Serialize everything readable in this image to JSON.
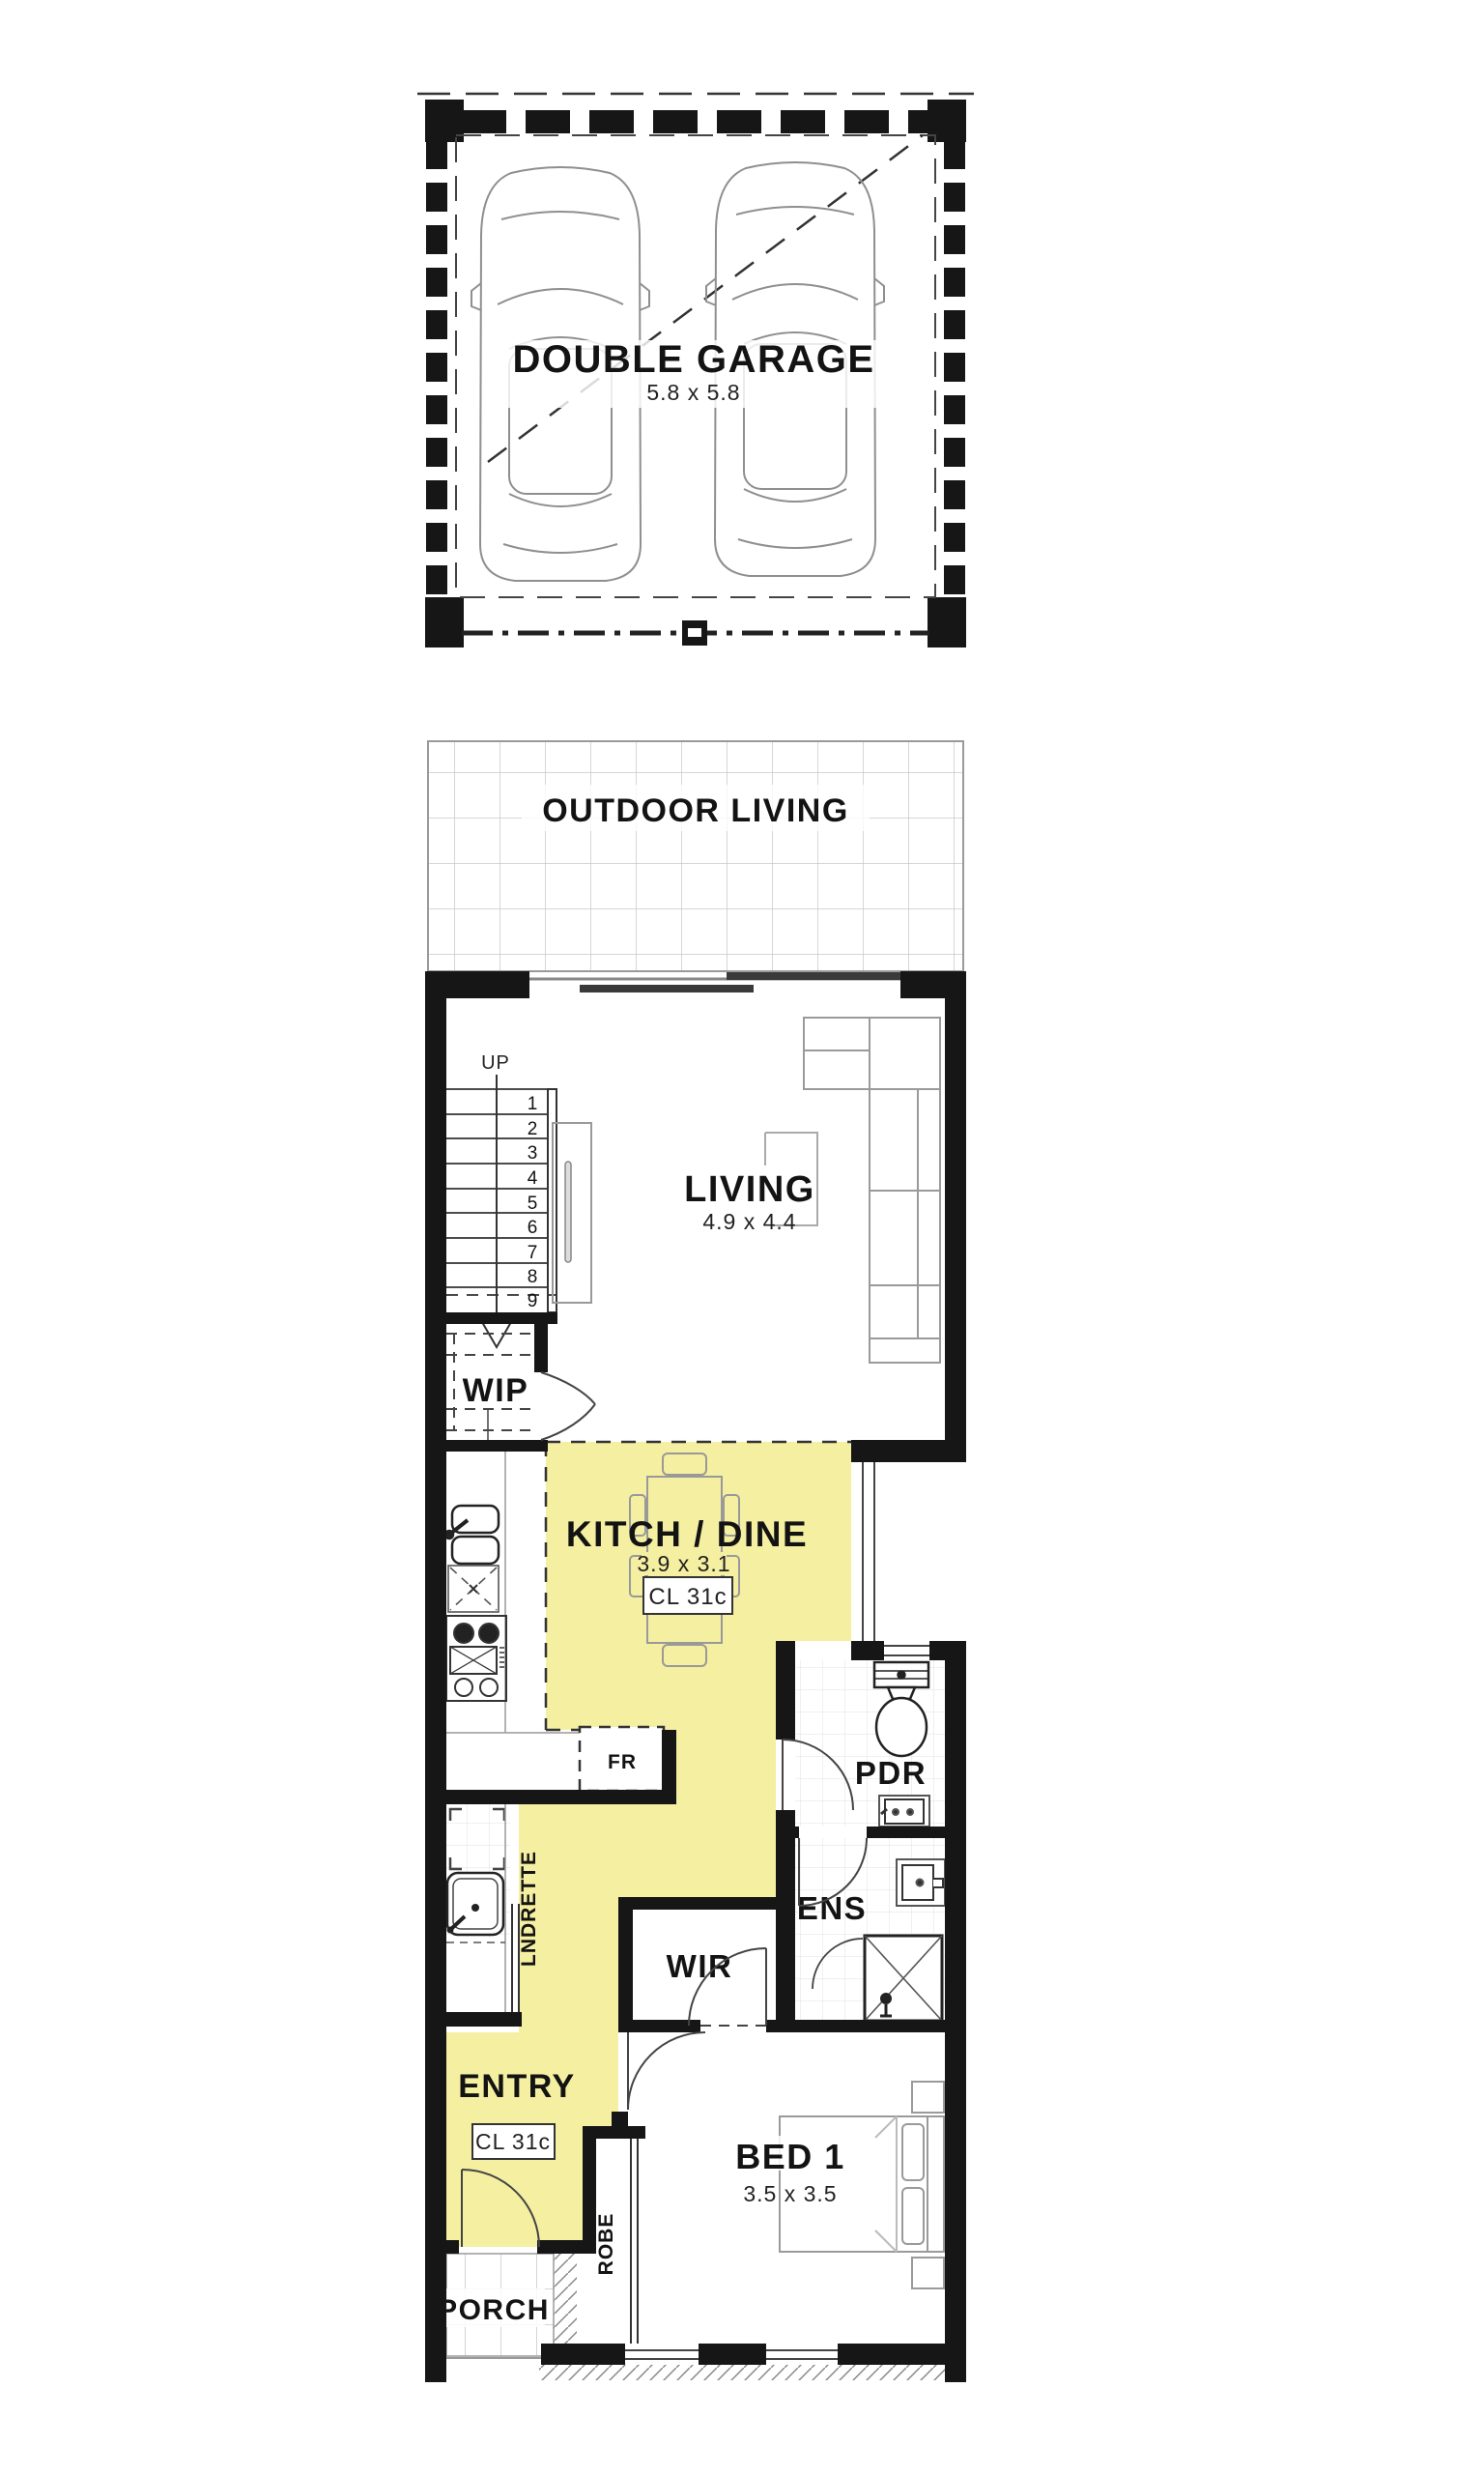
{
  "title": "Two storey home floor plan - ground floor",
  "colors": {
    "highlight": "#f5efa1",
    "wall": "#161616"
  },
  "plan": {
    "garage": {
      "name": "DOUBLE GARAGE",
      "dim": "5.8 x 5.8"
    },
    "outdoor_living": {
      "name": "OUTDOOR LIVING"
    },
    "living": {
      "name": "LIVING",
      "dim": "4.9 x 4.4",
      "stairs_label": "UP",
      "steps": [
        "1",
        "2",
        "3",
        "4",
        "5",
        "6",
        "7",
        "8",
        "9"
      ]
    },
    "wip": {
      "name": "WIP"
    },
    "kitchen_dine": {
      "name": "KITCH / DINE",
      "dim": "3.9 x 3.1",
      "ceiling_label": "CL 31c",
      "fridge_label": "FR"
    },
    "pdr": {
      "name": "PDR"
    },
    "ens": {
      "name": "ENS"
    },
    "wir": {
      "name": "WIR"
    },
    "laundrette": {
      "name": "LNDRETTE"
    },
    "entry": {
      "name": "ENTRY",
      "ceiling_label": "CL 31c"
    },
    "robe": {
      "name": "ROBE"
    },
    "porch": {
      "name": "PORCH"
    },
    "bed1": {
      "name": "BED 1",
      "dim": "3.5 x 3.5"
    }
  }
}
